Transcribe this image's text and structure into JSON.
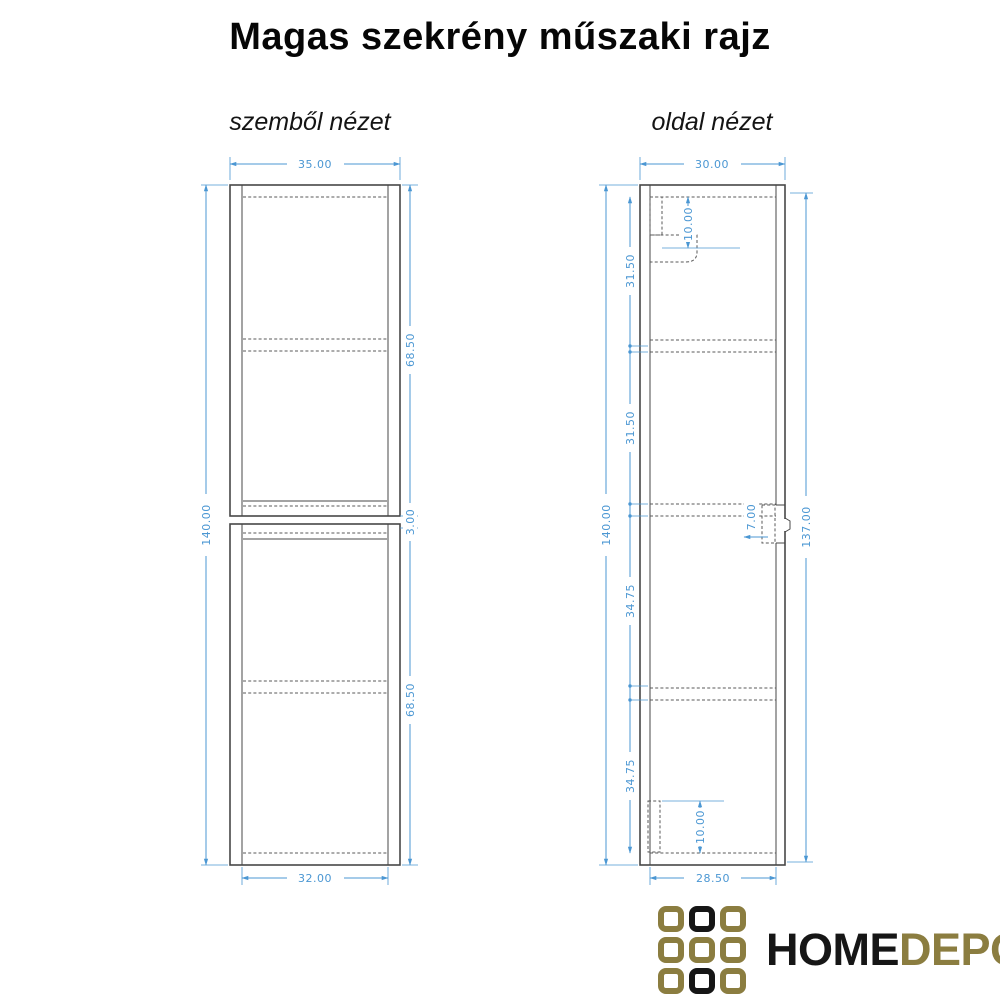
{
  "title": "Magas szekrény műszaki rajz",
  "front_view": {
    "label": "szemből nézet",
    "dims": {
      "outer_width": "35.00",
      "outer_height": "140.00",
      "upper_unit_height": "68.50",
      "middle_gap": "3.00",
      "lower_unit_height": "68.50",
      "inner_width": "32.00"
    }
  },
  "side_view": {
    "label": "oldal nézet",
    "dims": {
      "outer_depth": "30.00",
      "outer_height": "140.00",
      "front_height": "137.00",
      "top_bracket_drop": "10.00",
      "section_1": "31.50",
      "section_2": "31.50",
      "section_3": "34.75",
      "section_4": "34.75",
      "bracket_depth": "7.00",
      "bottom_bracket_height": "10.00",
      "inner_depth": "28.50"
    }
  },
  "logo": {
    "home": "HOME",
    "depo": "DEPO",
    "grid_pattern": [
      "gold",
      "black",
      "gold",
      "gold",
      "gold",
      "gold",
      "gold",
      "black",
      "gold"
    ]
  },
  "colors": {
    "dimension_blue": "#4b97d3",
    "outline_gray": "#474747",
    "logo_gold": "#8b7d40",
    "logo_black": "#161616"
  }
}
